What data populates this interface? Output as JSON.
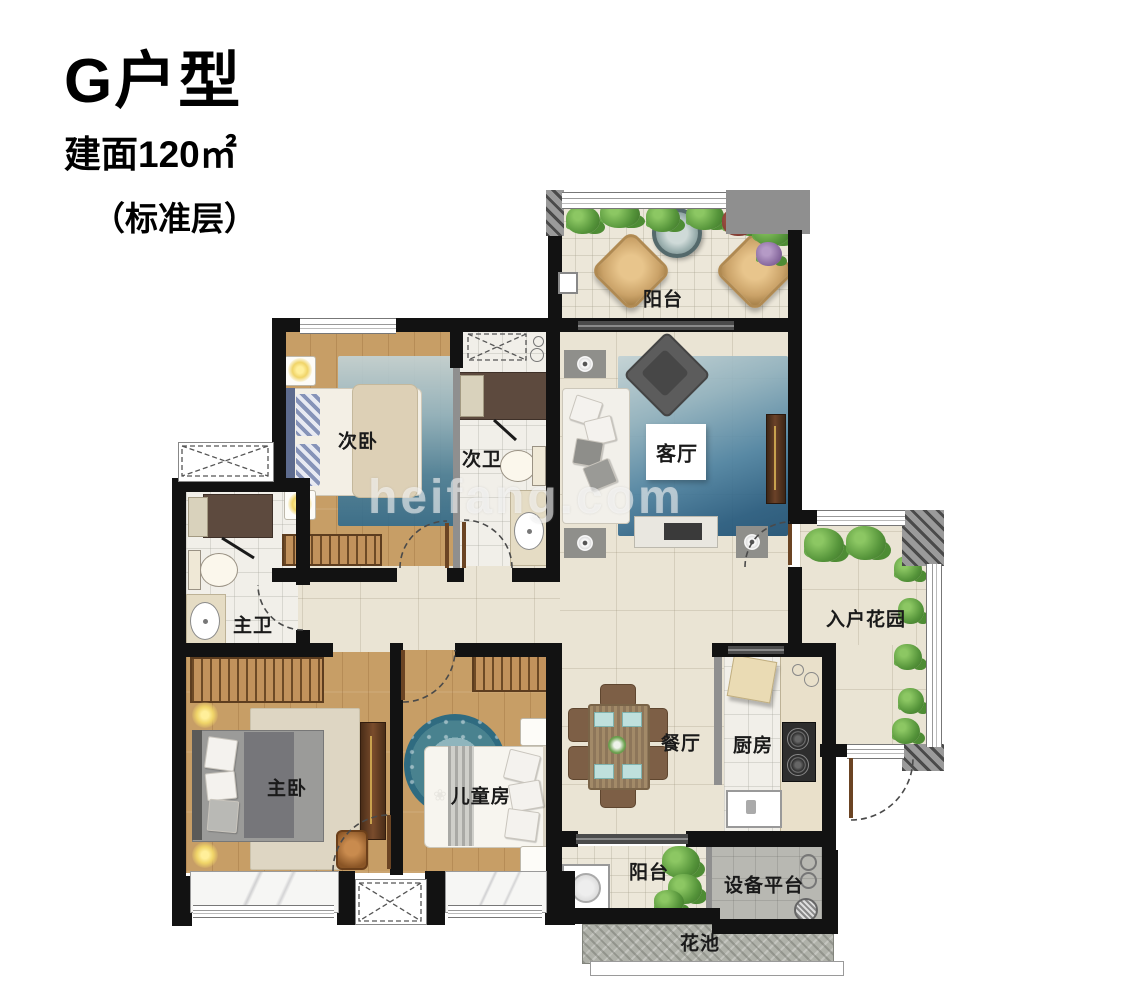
{
  "title": {
    "unit": "G户型",
    "area": "建面120㎡",
    "floor": "（标准层）"
  },
  "watermark": "heifang.com",
  "icons": {
    "kids_flower": "❀"
  },
  "rooms": {
    "balcony_top": {
      "label": "阳台"
    },
    "bedroom2": {
      "label": "次卧"
    },
    "bath2": {
      "label": "次卫"
    },
    "living": {
      "label": "客厅"
    },
    "bath_master": {
      "label": "主卫"
    },
    "entry_garden": {
      "label": "入户花园"
    },
    "bedroom_master": {
      "label": "主卧"
    },
    "kids_room": {
      "label": "儿童房"
    },
    "dining": {
      "label": "餐厅"
    },
    "kitchen": {
      "label": "厨房"
    },
    "balcony_bottom": {
      "label": "阳台"
    },
    "equipment": {
      "label": "设备平台"
    },
    "flower_bed": {
      "label": "花池"
    }
  },
  "colors": {
    "wall": "#121212",
    "wood_floor": "#c79e66",
    "marble_floor": "#eae4d4",
    "rug_blue": "#2e6b90",
    "rug_beige": "#ded6c3",
    "plant_green": "#55943a",
    "equipment_gray": "#b8b8b2"
  }
}
